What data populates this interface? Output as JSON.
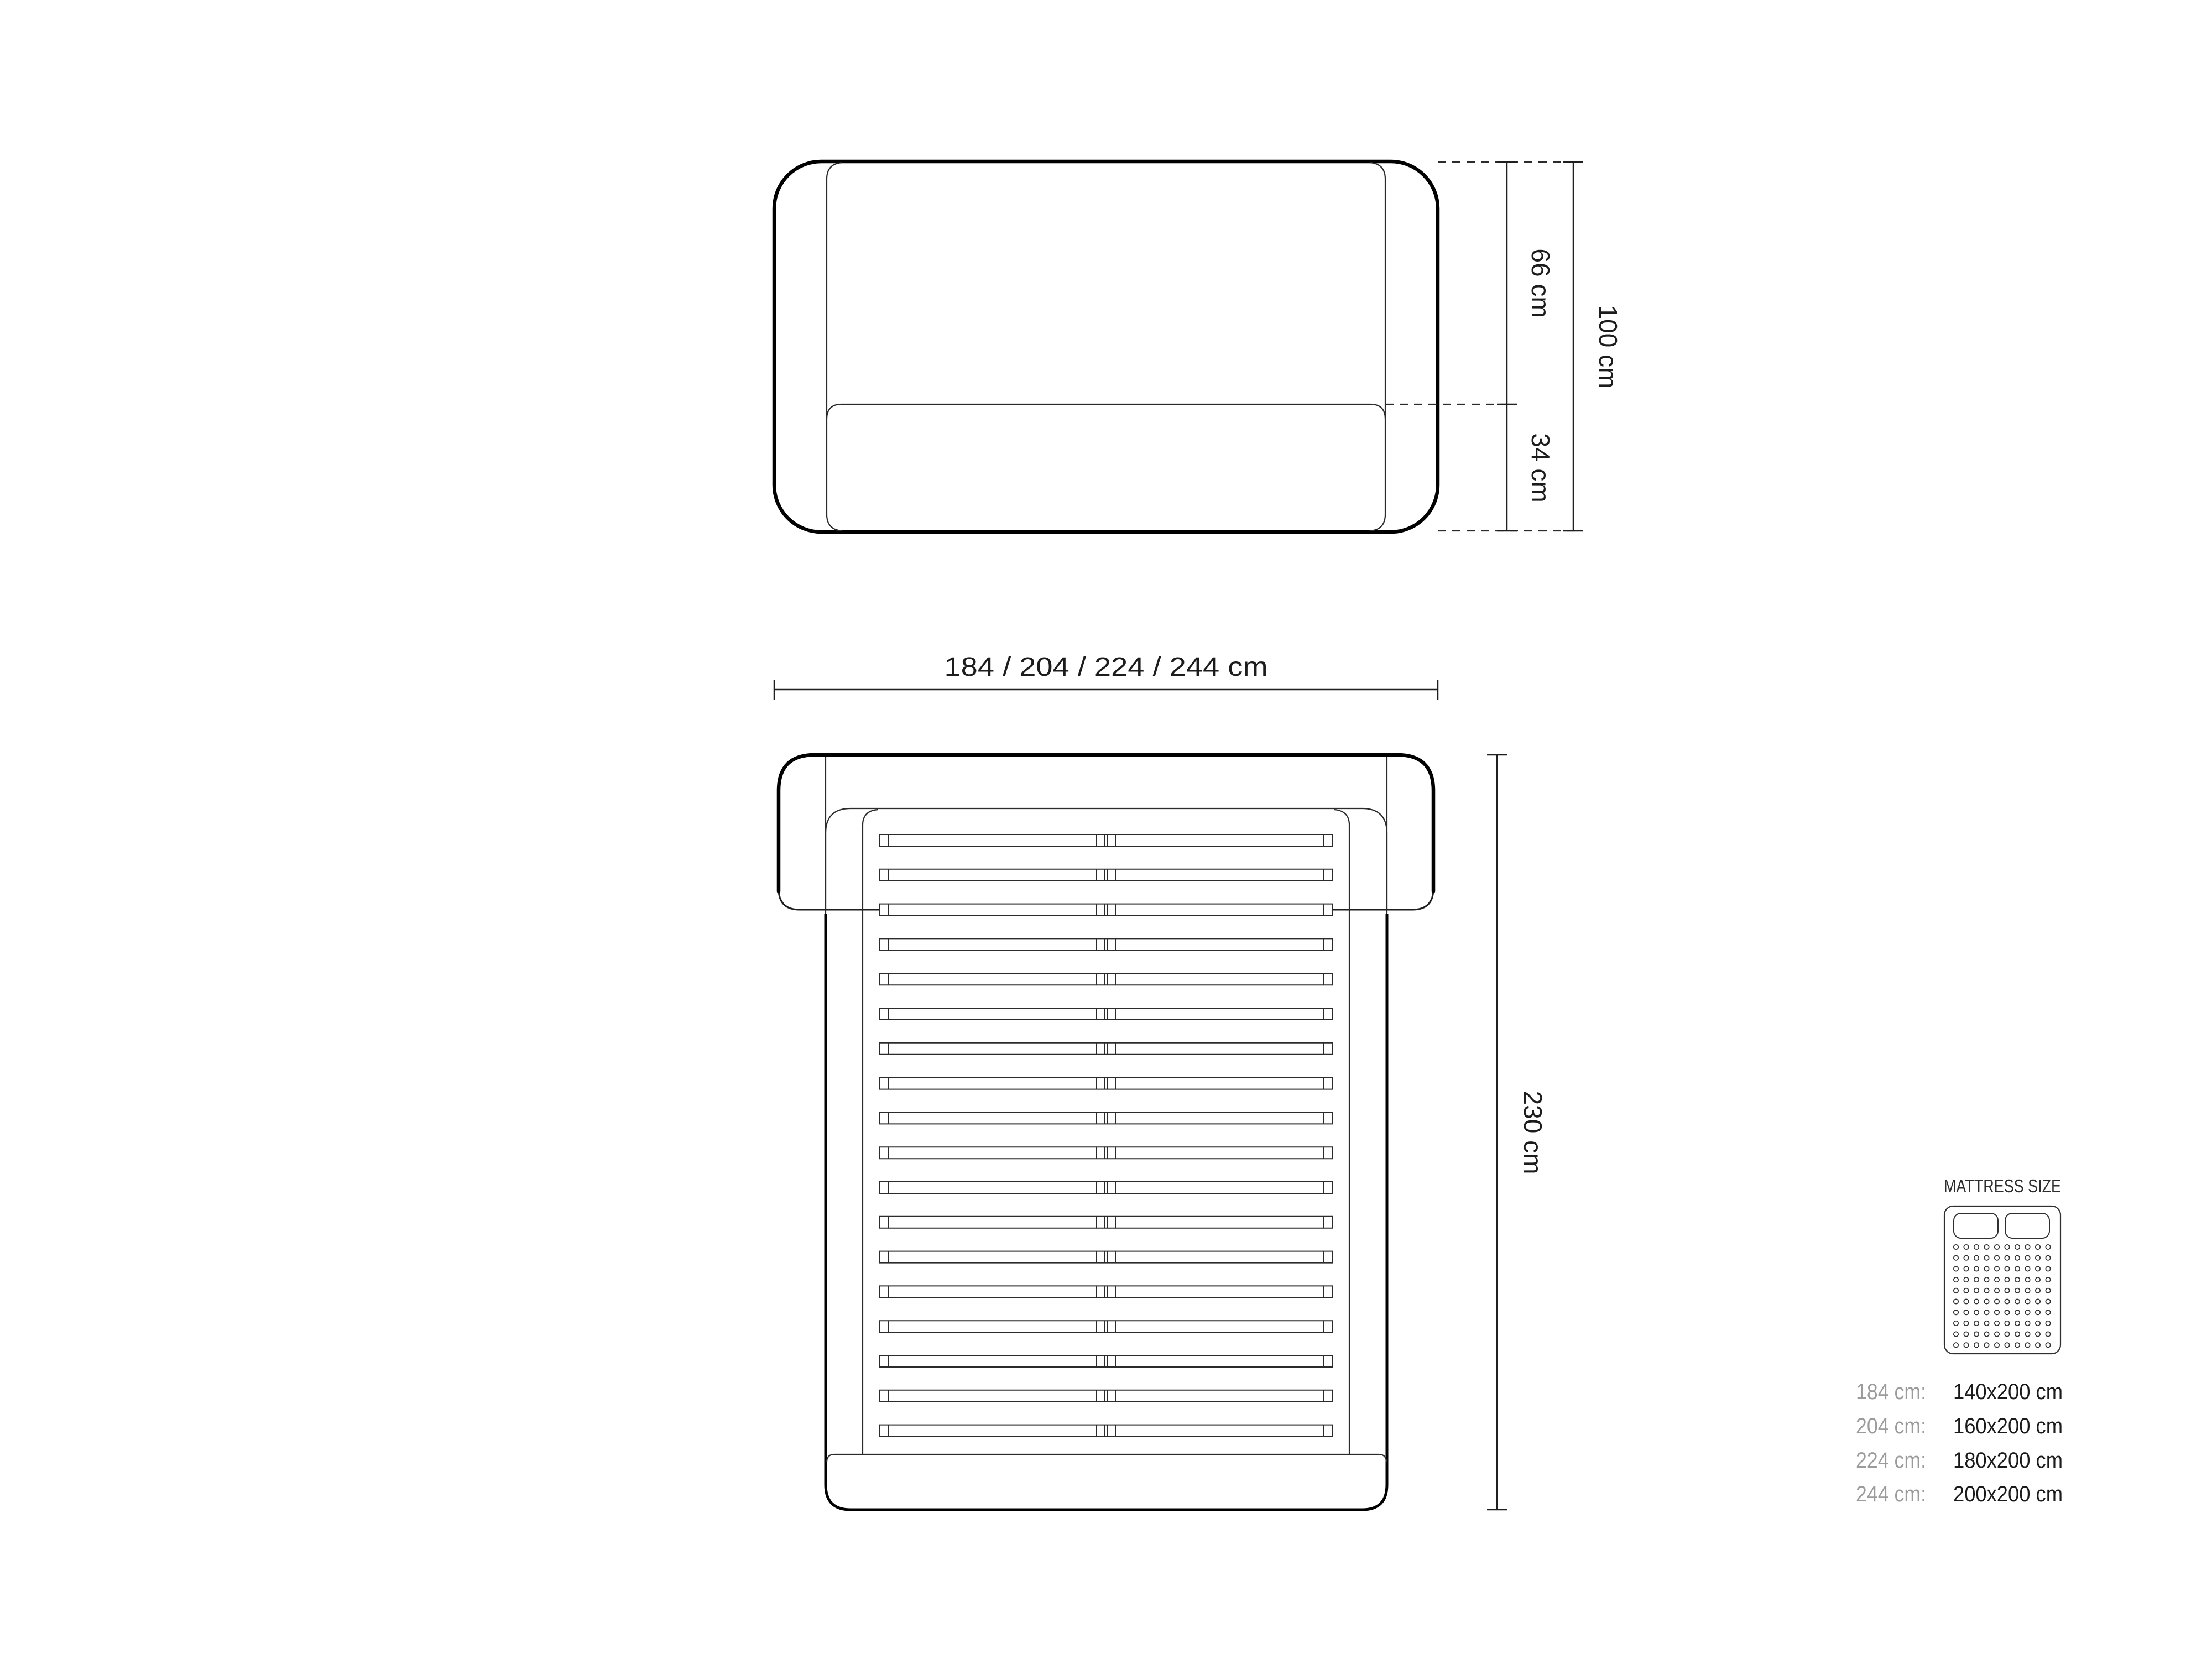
{
  "front_view": {
    "dim_66": "66 cm",
    "dim_34": "34 cm",
    "dim_100": "100 cm",
    "width_label": "184 / 204 / 224 / 244 cm"
  },
  "top_view": {
    "dim_230": "230 cm",
    "slat_count": 18
  },
  "mattress_panel": {
    "title": "MATTRESS SIZE",
    "icon": {
      "dot_rows": 10,
      "dot_cols": 10,
      "pillow_count": 2
    },
    "rows": [
      {
        "frame": "184 cm:",
        "mattress": "140x200 cm"
      },
      {
        "frame": "204 cm:",
        "mattress": "160x200 cm"
      },
      {
        "frame": "224 cm:",
        "mattress": "180x200 cm"
      },
      {
        "frame": "244 cm:",
        "mattress": "200x200 cm"
      }
    ]
  },
  "colors": {
    "line": "#000000",
    "thin_line": "#2b2b2b",
    "text": "#1c1c1c",
    "muted_text": "#9b9b9b",
    "background": "#ffffff"
  }
}
